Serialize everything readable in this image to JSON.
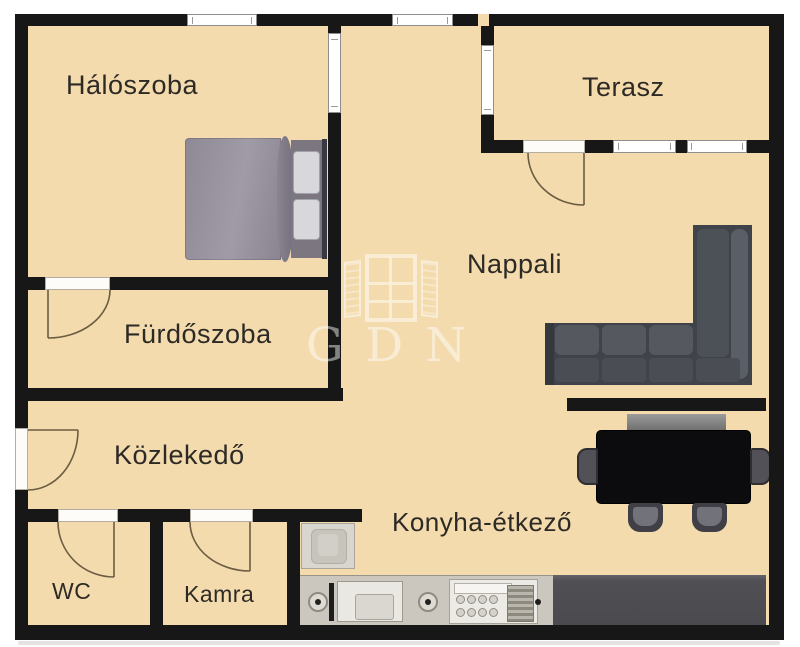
{
  "watermark": {
    "brand": "GDN"
  },
  "rooms": {
    "haloszoba": {
      "label": "Hálószoba"
    },
    "terasz": {
      "label": "Terasz"
    },
    "nappali": {
      "label": "Nappali"
    },
    "furdoszoba": {
      "label": "Fürdőszoba"
    },
    "kozlekedo": {
      "label": "Közlekedő"
    },
    "wc": {
      "label": "WC"
    },
    "kamra": {
      "label": "Kamra"
    },
    "konyha_etkezo": {
      "label": "Konyha-étkező"
    }
  },
  "furniture_icons": [
    "double-bed-icon",
    "corner-sofa-icon",
    "dining-table-icon",
    "dining-chair-icon",
    "sideboard-bench-icon",
    "washing-machine-icon",
    "kitchen-counter-icon",
    "sink-icon",
    "cooktop-icon",
    "window-icon",
    "door-arc-icon"
  ],
  "colors": {
    "floor": "#f3dbad",
    "wall": "#171717",
    "door_arc": "#6b5c42",
    "label_text": "#2d2a26",
    "watermark": "rgba(255,255,255,0.55)"
  }
}
